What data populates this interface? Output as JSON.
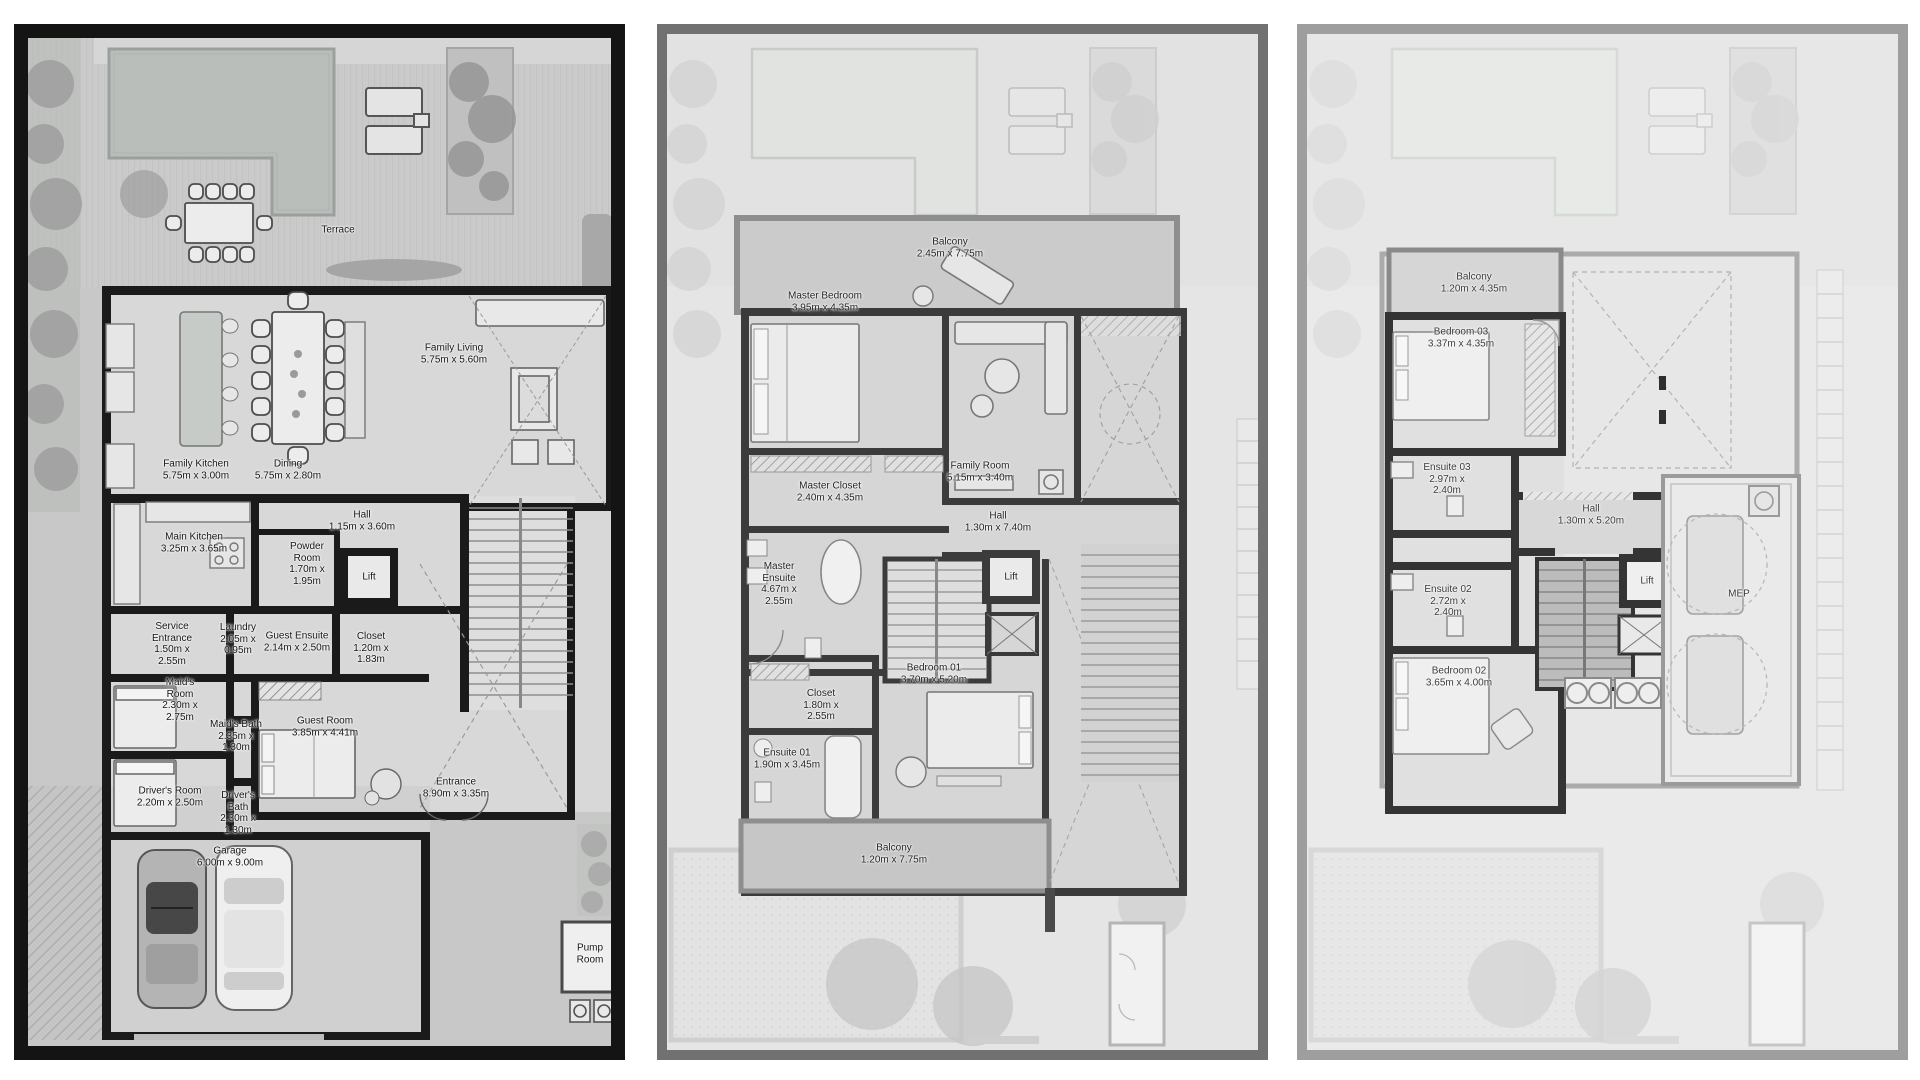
{
  "sheet": {
    "background": "#ffffff",
    "pool_color": "#babeba",
    "wall_color_ground": "#1a1a1a",
    "wall_color_first": "#3b3b3b",
    "wall_color_second": "#343434"
  },
  "floors": [
    {
      "name": "ground-floor",
      "labels": [
        {
          "text": "Terrace",
          "dims": ""
        },
        {
          "text": "Family Living",
          "dims": "5.75m x 5.60m"
        },
        {
          "text": "Family Kitchen",
          "dims": "5.75m x 3.00m"
        },
        {
          "text": "Dining",
          "dims": "5.75m x 2.80m"
        },
        {
          "text": "Hall",
          "dims": "1.15m x 3.60m"
        },
        {
          "text": "Main Kitchen",
          "dims": "3.25m x 3.65m"
        },
        {
          "text": "Powder Room",
          "dims": "1.70m x 1.95m"
        },
        {
          "text": "Lift",
          "dims": ""
        },
        {
          "text": "Service Entrance",
          "dims": "1.50m x 2.55m"
        },
        {
          "text": "Laundry",
          "dims": "2.05m x 0.95m"
        },
        {
          "text": "Guest Ensuite",
          "dims": "2.14m x 2.50m"
        },
        {
          "text": "Closet",
          "dims": "1.20m x 1.83m"
        },
        {
          "text": "Maid's Room",
          "dims": "2.30m x 2.75m"
        },
        {
          "text": "Maid's Bath",
          "dims": "2.35m x 1.30m"
        },
        {
          "text": "Guest Room",
          "dims": "3.85m x 4.41m"
        },
        {
          "text": "Driver's Room",
          "dims": "2.20m x 2.50m"
        },
        {
          "text": "Driver's Bath",
          "dims": "2.30m x 1.30m"
        },
        {
          "text": "Entrance",
          "dims": "8.90m x 3.35m"
        },
        {
          "text": "Garage",
          "dims": "6.00m x 9.00m"
        },
        {
          "text": "Pump Room",
          "dims": ""
        }
      ]
    },
    {
      "name": "first-floor",
      "labels": [
        {
          "text": "Balcony",
          "dims": "2.45m x 7.75m"
        },
        {
          "text": "Master Bedroom",
          "dims": "3.95m x 4.35m"
        },
        {
          "text": "Master Closet",
          "dims": "2.40m x 4.35m"
        },
        {
          "text": "Family Room",
          "dims": "5.15m x 3.40m"
        },
        {
          "text": "Hall",
          "dims": "1.30m x 7.40m"
        },
        {
          "text": "Master Ensuite",
          "dims": "4.67m x 2.55m"
        },
        {
          "text": "Lift",
          "dims": ""
        },
        {
          "text": "Closet",
          "dims": "1.80m x 2.55m"
        },
        {
          "text": "Bedroom 01",
          "dims": "3.70m x 5.20m"
        },
        {
          "text": "Ensuite 01",
          "dims": "1.90m x 3.45m"
        },
        {
          "text": "Balcony",
          "dims": "1.20m x 7.75m"
        }
      ]
    },
    {
      "name": "second-floor",
      "labels": [
        {
          "text": "Balcony",
          "dims": "1.20m x 4.35m"
        },
        {
          "text": "Bedroom 03",
          "dims": "3.37m x 4.35m"
        },
        {
          "text": "Ensuite 03",
          "dims": "2.97m x 2.40m"
        },
        {
          "text": "Hall",
          "dims": "1.30m x 5.20m"
        },
        {
          "text": "Ensuite 02",
          "dims": "2.72m x 2.40m"
        },
        {
          "text": "Bedroom 02",
          "dims": "3.65m x 4.00m"
        },
        {
          "text": "Lift",
          "dims": ""
        },
        {
          "text": "MEP",
          "dims": ""
        }
      ]
    }
  ]
}
